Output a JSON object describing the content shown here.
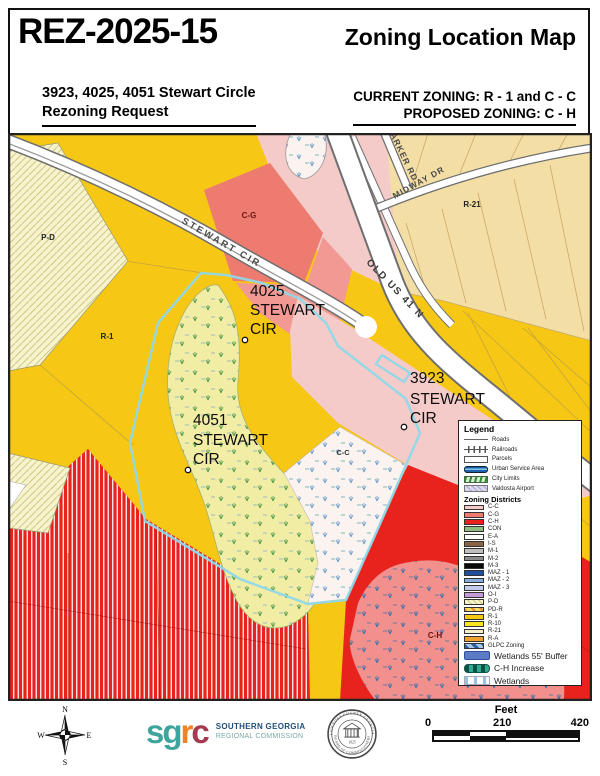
{
  "header": {
    "rez_number": "REZ-2025-15",
    "map_title": "Zoning Location Map",
    "address_line": "3923, 4025, 4051 Stewart Circle",
    "request_line": "Rezoning Request",
    "current_zoning": "CURRENT ZONING: R - 1 and C - C",
    "proposed_zoning": "PROPOSED ZONING: C - H"
  },
  "map": {
    "zone_labels": [
      {
        "label": "P-D"
      },
      {
        "label": "R-1"
      },
      {
        "label": "C-G"
      },
      {
        "label": "R-21"
      },
      {
        "label": "C-C"
      },
      {
        "label": "C-H"
      }
    ],
    "road_labels": [
      "STEWART CIR",
      "OLD US 41 N",
      "BARKER RD",
      "MIDWAY DR"
    ],
    "addresses": [
      {
        "lines": [
          "4025",
          "STEWART",
          "CIR"
        ]
      },
      {
        "lines": [
          "4051",
          "STEWART",
          "CIR"
        ]
      },
      {
        "lines": [
          "3923",
          "STEWART",
          "CIR"
        ]
      }
    ],
    "subject_boundary_color": "#8FD8E8"
  },
  "legend": {
    "title": "Legend",
    "items": [
      {
        "label": "Roads",
        "swatch": "roads"
      },
      {
        "label": "Railroads",
        "swatch": "railroads"
      },
      {
        "label": "Parcels",
        "swatch": "parcels"
      },
      {
        "label": "Urban Service Area",
        "swatch": "urban-service-area"
      },
      {
        "label": "City Limits",
        "swatch": "city-limits"
      },
      {
        "label": "Valdosta Airport",
        "swatch": "valdosta-airport"
      }
    ],
    "districts_title": "Zoning Districts",
    "districts": [
      {
        "label": "C-C",
        "color": "#F4CBC8"
      },
      {
        "label": "C-G",
        "color": "#EE7B70"
      },
      {
        "label": "C-H",
        "color": "#E8231D"
      },
      {
        "label": "CON",
        "color": "#8FBC7F"
      },
      {
        "label": "E-A",
        "color": "#FFFFFF"
      },
      {
        "label": "I-S",
        "color": "#8B6347"
      },
      {
        "label": "M-1",
        "color": "#BFBFBF"
      },
      {
        "label": "M-2",
        "color": "#8C8C8C"
      },
      {
        "label": "M-3",
        "color": "#0A0A0A"
      },
      {
        "label": "MAZ - 1",
        "color": "#1F4E9C"
      },
      {
        "label": "MAZ - 2",
        "color": "#85AEDC"
      },
      {
        "label": "MAZ - 3",
        "color": "#C5CBEC"
      },
      {
        "label": "O-I",
        "color": "#C49BD8"
      },
      {
        "label": "P-D",
        "color": "#F7F3CE",
        "pattern": "pd"
      },
      {
        "label": "PD-R",
        "color": "#F5DF5E",
        "pattern": "pdr"
      },
      {
        "label": "R-1",
        "color": "#F6C714"
      },
      {
        "label": "R-10",
        "color": "#F7E51E"
      },
      {
        "label": "R-21",
        "color": "#F6EECB"
      },
      {
        "label": "R-A",
        "color": "#F0A030"
      },
      {
        "label": "GLPC Zoning",
        "color": "#A8C8E8",
        "pattern": "glpc"
      }
    ],
    "overlays": [
      {
        "label": "Wetlands 55' Buffer",
        "swatch": "wetlands-buffer",
        "color": "#5B7BC7"
      },
      {
        "label": "C-H Increase",
        "swatch": "ch-increase",
        "color": "#31A893"
      },
      {
        "label": "Wetlands",
        "swatch": "wetlands",
        "color": "#FDFDFD"
      }
    ]
  },
  "footer": {
    "compass": {
      "n": "N",
      "e": "E",
      "s": "S",
      "w": "W"
    },
    "logo": {
      "letters": [
        {
          "char": "s",
          "color": "#3EA59D"
        },
        {
          "char": "g",
          "color": "#3EA59D"
        },
        {
          "char": "r",
          "color": "#F58220"
        },
        {
          "char": "c",
          "color": "#A63A50"
        }
      ],
      "org_line1": "SOUTHERN GEORGIA",
      "org_line2": "REGIONAL COMMISSION"
    },
    "seal": {
      "top_text": "LOWNDES COUNTY GEORGIA",
      "bottom_text": "BOARD OF COMMISSIONERS",
      "year": "1825"
    },
    "scalebar": {
      "title": "Feet",
      "ticks": [
        "0",
        "210",
        "420"
      ]
    }
  }
}
